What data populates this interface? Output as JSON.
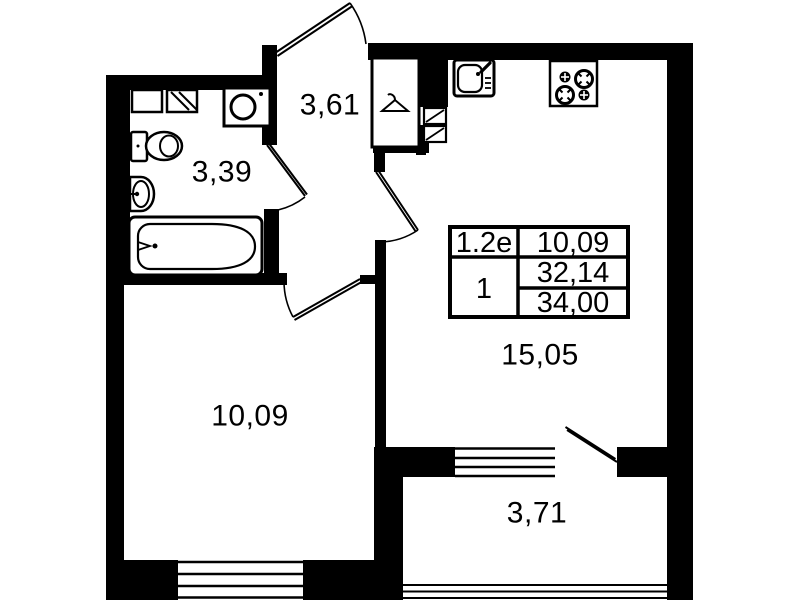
{
  "plan": {
    "title": "apartment-floor-plan",
    "rooms": {
      "hallway": {
        "name": "hallway",
        "area": "3,61"
      },
      "bathroom": {
        "name": "bathroom",
        "area": "3,39"
      },
      "bedroom": {
        "name": "bedroom",
        "area": "10,09"
      },
      "kitchen_living": {
        "name": "kitchen-living-room",
        "area": "15,05"
      },
      "balcony": {
        "name": "balcony",
        "area": "3,71"
      }
    },
    "info_table": {
      "flat_type": "1.2e",
      "rooms": "1",
      "values": [
        "10,09",
        "32,14",
        "34,00"
      ]
    },
    "colors": {
      "wall": "#000000",
      "background": "#ffffff",
      "line": "#000000"
    },
    "icons": [
      "toilet-icon",
      "washbasin-icon",
      "bathtub-icon",
      "washing-machine-icon",
      "bathroom-cabinet-icon",
      "bathroom-vent-icon",
      "vent-hatch-icon",
      "wardrobe-hanger-icon",
      "kitchen-sink-icon",
      "stove-icon",
      "door-leaf-icon",
      "door-arc-icon",
      "window-icon"
    ]
  }
}
